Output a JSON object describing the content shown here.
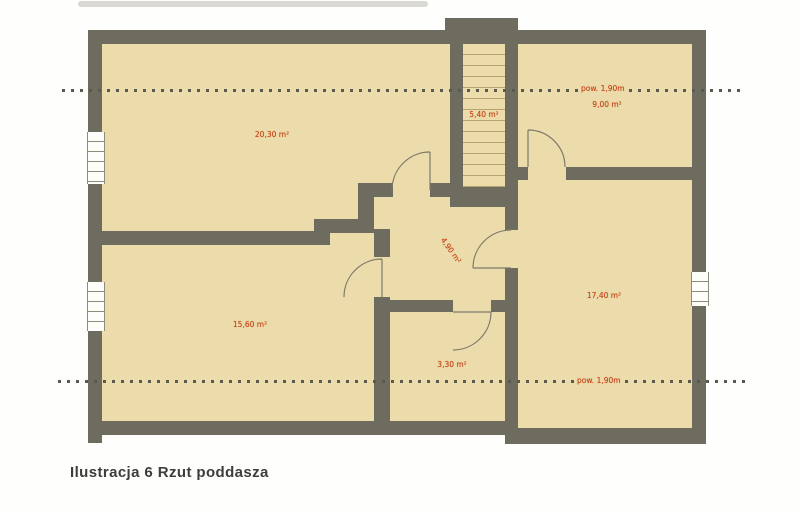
{
  "caption": "Ilustracja 6 Rzut poddasza",
  "floor_plan": {
    "rooms": [
      {
        "position": "top-left",
        "area": "20,30 m²"
      },
      {
        "position": "staircase",
        "area": "5,40 m²"
      },
      {
        "position": "top-right",
        "area": "9,00 m²"
      },
      {
        "position": "hall-center",
        "area": "4,90 m²"
      },
      {
        "position": "bottom-left",
        "area": "15,60 m²"
      },
      {
        "position": "bottom-middle",
        "area": "3,30 m²"
      },
      {
        "position": "bottom-right",
        "area": "17,40 m²"
      }
    ],
    "height_annotations": [
      {
        "position": "upper-line",
        "label": "pow. 1,90m"
      },
      {
        "position": "lower-line",
        "label": "pow. 1,90m"
      }
    ],
    "colors": {
      "wall": "#6e6c5e",
      "floor": "#ecdcab",
      "annotation_red": "#c23b10",
      "dotted_line": "#5a594e"
    }
  }
}
